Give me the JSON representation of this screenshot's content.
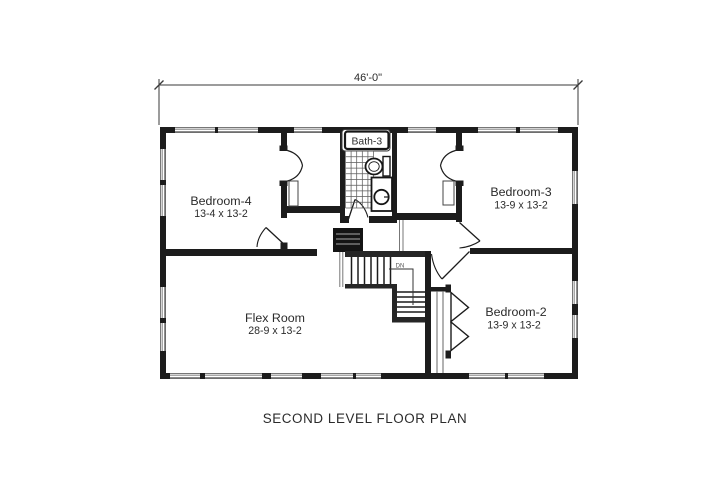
{
  "plan": {
    "overall_dimension": "46'-0\"",
    "caption": "SECOND LEVEL FLOOR PLAN",
    "stair_direction_label": "DN",
    "rooms": {
      "bedroom4": {
        "name": "Bedroom-4",
        "size": "13-4 x 13-2"
      },
      "bedroom3": {
        "name": "Bedroom-3",
        "size": "13-9 x 13-2"
      },
      "bedroom2": {
        "name": "Bedroom-2",
        "size": "13-9 x 13-2"
      },
      "flex": {
        "name": "Flex Room",
        "size": "28-9 x 13-2"
      },
      "bath": {
        "name": "Bath-3"
      }
    },
    "colors": {
      "wall": "#1c1c1c",
      "window_line": "#8a8a8a",
      "text": "#2b2b2b",
      "background": "#ffffff"
    }
  }
}
